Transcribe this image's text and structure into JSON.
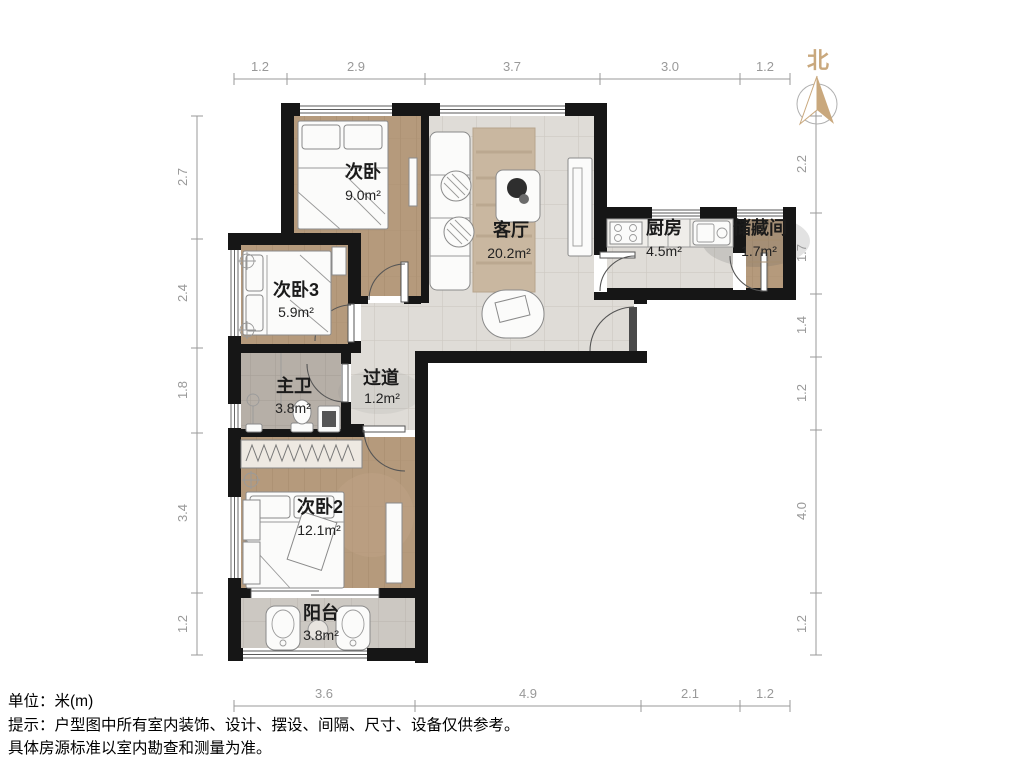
{
  "title": "户型图",
  "north": {
    "label": "北"
  },
  "rooms": [
    {
      "key": "bedroom1",
      "name": "次卧",
      "area": "9.0m²"
    },
    {
      "key": "living",
      "name": "客厅",
      "area": "20.2m²"
    },
    {
      "key": "kitchen",
      "name": "厨房",
      "area": "4.5m²"
    },
    {
      "key": "storage",
      "name": "储藏间",
      "area": "1.7m²"
    },
    {
      "key": "bedroom3",
      "name": "次卧3",
      "area": "5.9m²"
    },
    {
      "key": "bath",
      "name": "主卫",
      "area": "3.8m²"
    },
    {
      "key": "hallway",
      "name": "过道",
      "area": "1.2m²"
    },
    {
      "key": "bedroom2",
      "name": "次卧2",
      "area": "12.1m²"
    },
    {
      "key": "balcony",
      "name": "阳台",
      "area": "3.8m²"
    }
  ],
  "dims": {
    "top": [
      "1.2",
      "2.9",
      "3.7",
      "3.0",
      "1.2"
    ],
    "bottom": [
      "3.6",
      "4.9",
      "2.1",
      "1.2"
    ],
    "left": [
      "2.7",
      "2.4",
      "1.8",
      "3.4",
      "1.2"
    ],
    "right": [
      "2.2",
      "1.7",
      "1.4",
      "1.2",
      "4.0",
      "1.2"
    ]
  },
  "footer": {
    "unit": "单位：米(m)",
    "tip": "提示：户型图中所有室内装饰、设计、摆设、间隔、尺寸、设备仅供参考。",
    "tip2": "具体房源标准以室内勘查和测量为准。"
  },
  "colors": {
    "wall": "#161616",
    "wood_floor": "#b59a7c",
    "tile_floor": "#dfdcd7",
    "bath_tile": "#b6afa7",
    "balcony_tile": "#ccc8c2",
    "north_accent": "#c9a87d",
    "dimension_grey": "#9a9a9a",
    "label_black": "#1b1b1b"
  }
}
